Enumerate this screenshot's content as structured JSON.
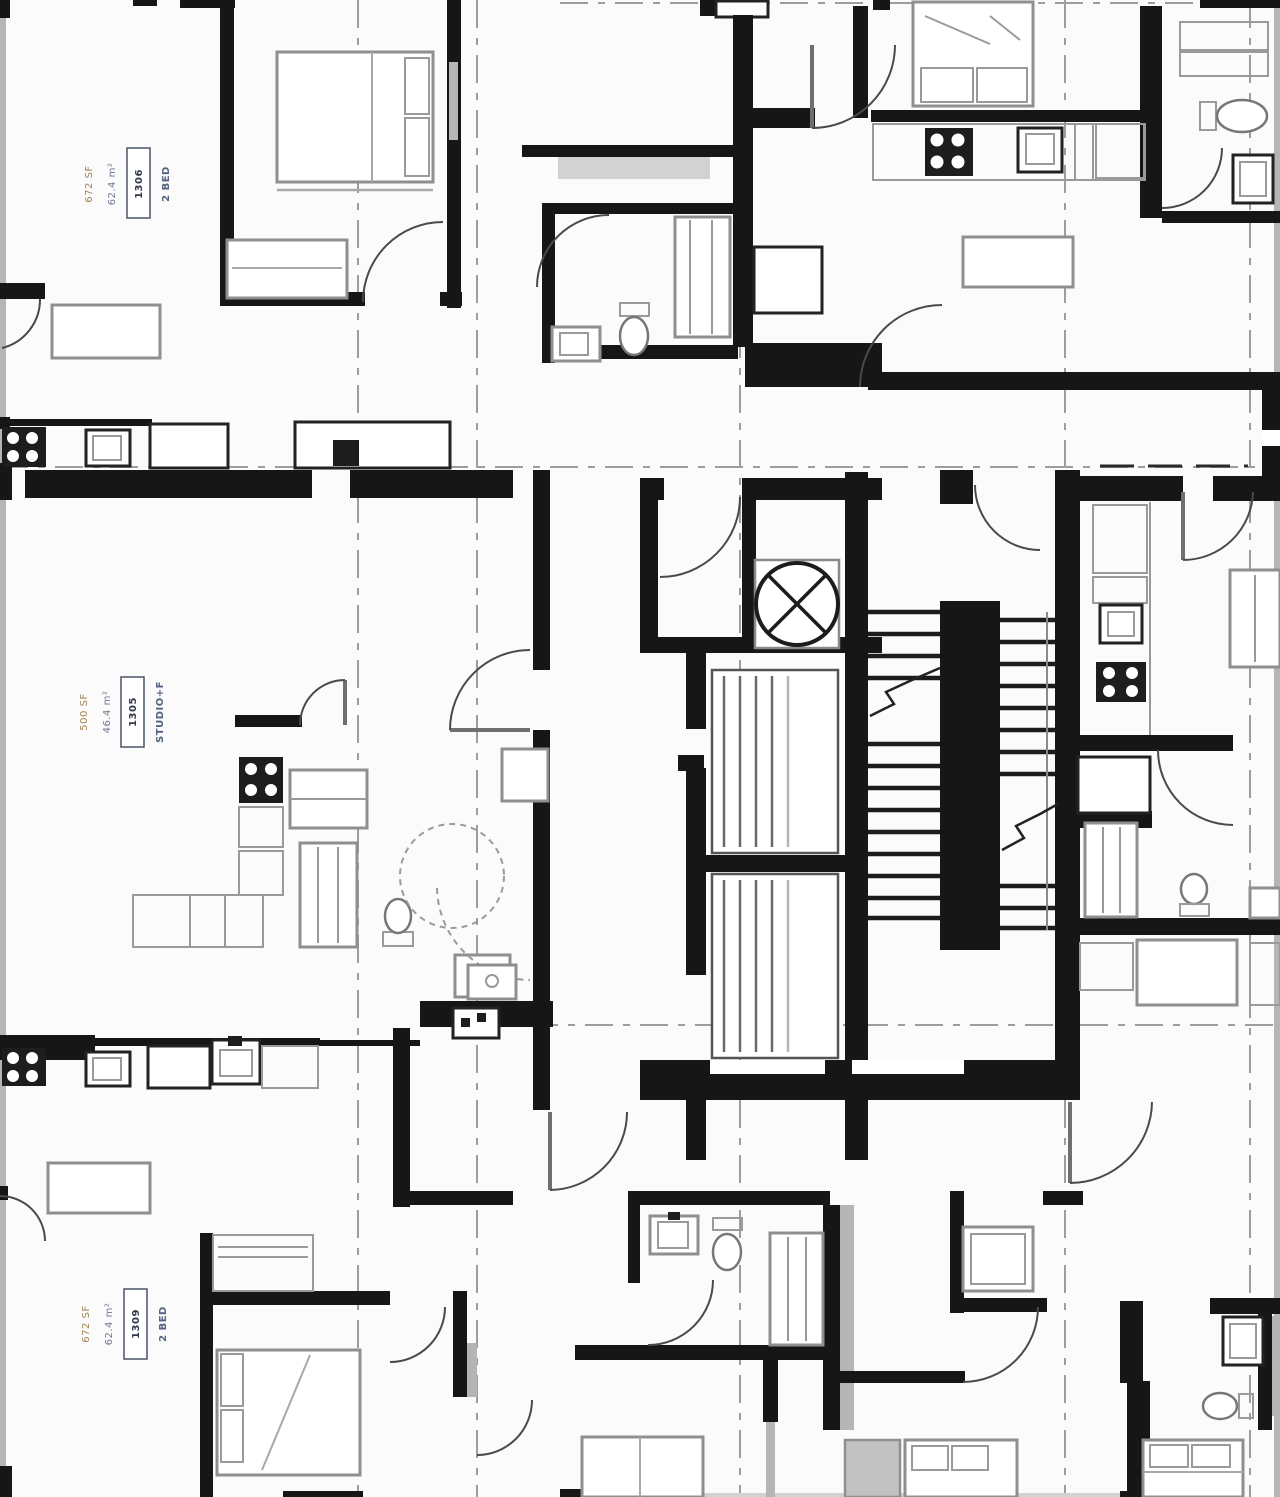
{
  "drawing": {
    "kind": "architectural floor plan (black-and-white apartment tower plate)",
    "background": "#fbfbfb",
    "wall_color": "#161616",
    "furniture_color": "#8f8f8f",
    "gridline_color": "#9d9d9d"
  },
  "units": [
    {
      "id": "top-left",
      "type": "2 BED",
      "number": "1306",
      "area_m2": "62.4 m²",
      "area_sf": "672 SF"
    },
    {
      "id": "middle-left",
      "type": "STUDIO+F",
      "number": "1305",
      "area_m2": "46.4 m²",
      "area_sf": "500 SF"
    },
    {
      "id": "bottom-left",
      "type": "2 BED",
      "number": "1309",
      "area_m2": "62.4 m²",
      "area_sf": "672 SF"
    }
  ],
  "core": {
    "elevators": 2,
    "stair_flights": 2,
    "vent_symbol": "circle-with-x"
  }
}
